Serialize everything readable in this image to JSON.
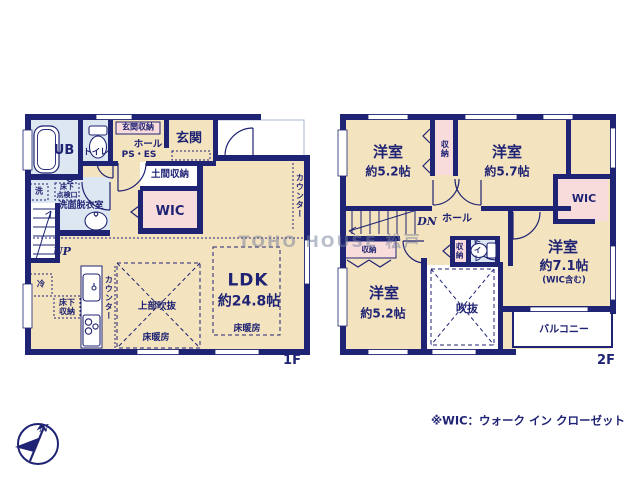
{
  "colors": {
    "wall": "#1f2373",
    "room_beige": "#f4e3bf",
    "closet_pink": "#f8dbdb",
    "wet_blue": "#dce7f2",
    "text_navy": "#1f2373"
  },
  "f1": {
    "floor_label": "1F",
    "ub": "UB",
    "toilet": "トイレ",
    "entrance_storage": "玄関収納",
    "hall": "ホール",
    "ps_es": "PS・ES",
    "entrance": "玄関",
    "doma_storage": "土間収納",
    "wic": "WIC",
    "laundry": "洗",
    "underfloor_hatch": "床下\n点検口",
    "washroom": "洗面脱衣室",
    "stairs_up": "UP",
    "fridge": "冷",
    "underfloor_storage": "床下\n収納",
    "kitchen_counter": "カウンター",
    "upper_void": "上部吹抜",
    "floor_heating": "床暖房",
    "ldk_name": "LDK",
    "ldk_size": "約24.8帖",
    "ldk_floor_heating": "床暖房",
    "side_counter": "カウンター"
  },
  "f2": {
    "floor_label": "2F",
    "room_nw_name": "洋室",
    "room_nw_size": "約5.2帖",
    "closet_north": "収納",
    "room_ne_name": "洋室",
    "room_ne_size": "約5.7帖",
    "wic": "WIC",
    "stairs_down": "DN",
    "hall": "ホール",
    "closet_center": "収納",
    "toilet": "トイレ",
    "room_e_name": "洋室",
    "room_e_size": "約7.1帖",
    "room_e_note": "(WIC含む)",
    "closet_sw": "収納",
    "room_sw_name": "洋室",
    "room_sw_size": "約5.2帖",
    "void": "吹抜",
    "balcony": "バルコニー"
  },
  "watermark": "TOHO HOUSE 松戸",
  "footnote": "※WIC：ウォーク イン クローゼット",
  "compass_north": "N"
}
